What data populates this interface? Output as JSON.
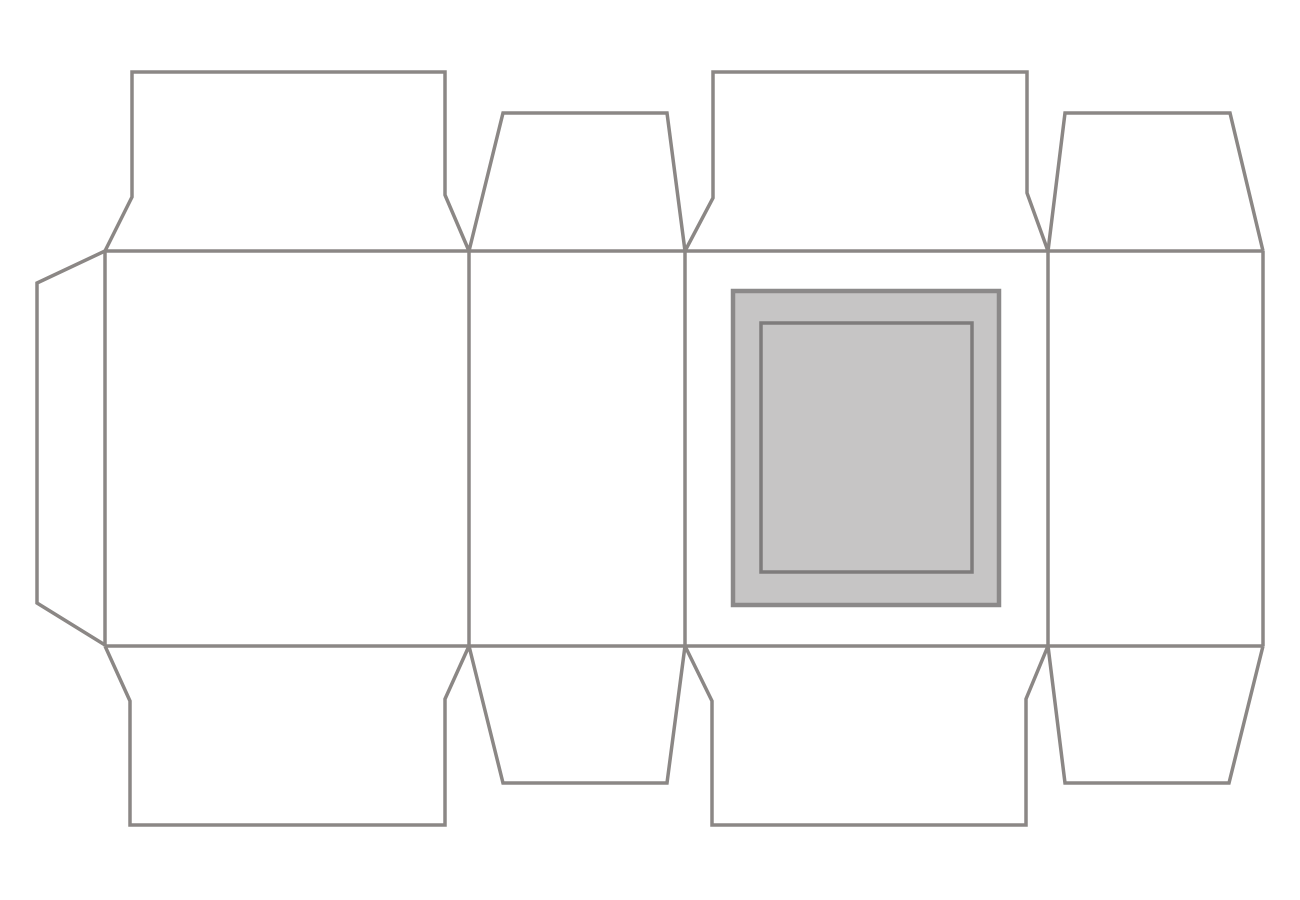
{
  "canvas": {
    "width": 1300,
    "height": 900,
    "background_color": "#ffffff"
  },
  "diagram": {
    "kind": "packaging-dieline",
    "line_color": "#8b8785",
    "line_width": 3.5,
    "window_fill_color": "#c6c5c5",
    "shapes": [
      {
        "name": "glue-tab-outline",
        "kind": "polyline",
        "points": [
          [
            105,
            251
          ],
          [
            37,
            283
          ],
          [
            37,
            603
          ],
          [
            105,
            645
          ]
        ]
      },
      {
        "name": "top-flap-1-outline",
        "kind": "polyline",
        "points": [
          [
            105,
            251
          ],
          [
            132,
            197
          ],
          [
            132,
            72
          ],
          [
            445,
            72
          ],
          [
            445,
            195
          ],
          [
            469,
            251
          ]
        ]
      },
      {
        "name": "top-flap-2-outline",
        "kind": "polyline",
        "points": [
          [
            469,
            251
          ],
          [
            503,
            113
          ],
          [
            667,
            113
          ],
          [
            685,
            251
          ]
        ]
      },
      {
        "name": "top-flap-3-outline",
        "kind": "polyline",
        "points": [
          [
            685,
            251
          ],
          [
            713,
            198
          ],
          [
            713,
            72
          ],
          [
            1027,
            72
          ],
          [
            1027,
            193
          ],
          [
            1048,
            251
          ]
        ]
      },
      {
        "name": "top-flap-4-outline",
        "kind": "polyline",
        "points": [
          [
            1048,
            251
          ],
          [
            1065,
            113
          ],
          [
            1230,
            113
          ],
          [
            1263,
            251
          ]
        ]
      },
      {
        "name": "bottom-flap-1-outline",
        "kind": "polyline",
        "points": [
          [
            105,
            646
          ],
          [
            130,
            701
          ],
          [
            130,
            825
          ],
          [
            445,
            825
          ],
          [
            445,
            699
          ],
          [
            469,
            646
          ]
        ]
      },
      {
        "name": "bottom-flap-2-outline",
        "kind": "polyline",
        "points": [
          [
            469,
            646
          ],
          [
            503,
            783
          ],
          [
            667,
            783
          ],
          [
            685,
            646
          ]
        ]
      },
      {
        "name": "bottom-flap-3-outline",
        "kind": "polyline",
        "points": [
          [
            685,
            646
          ],
          [
            712,
            701
          ],
          [
            712,
            825
          ],
          [
            1026,
            825
          ],
          [
            1026,
            699
          ],
          [
            1048,
            646
          ]
        ]
      },
      {
        "name": "bottom-flap-4-outline",
        "kind": "polyline",
        "points": [
          [
            1048,
            646
          ],
          [
            1065,
            783
          ],
          [
            1229,
            783
          ],
          [
            1263,
            646
          ]
        ]
      },
      {
        "name": "top-fold-line",
        "kind": "line",
        "points": [
          [
            105,
            251
          ],
          [
            1263,
            251
          ]
        ]
      },
      {
        "name": "bottom-fold-line",
        "kind": "line",
        "points": [
          [
            105,
            646
          ],
          [
            1263,
            646
          ]
        ]
      },
      {
        "name": "panel-1-left-edge",
        "kind": "line",
        "points": [
          [
            105,
            251
          ],
          [
            105,
            646
          ]
        ]
      },
      {
        "name": "panel-1-2-fold-line",
        "kind": "line",
        "points": [
          [
            469,
            251
          ],
          [
            469,
            646
          ]
        ]
      },
      {
        "name": "panel-2-3-fold-line",
        "kind": "line",
        "points": [
          [
            685,
            251
          ],
          [
            685,
            646
          ]
        ]
      },
      {
        "name": "panel-3-4-fold-line",
        "kind": "line",
        "points": [
          [
            1048,
            251
          ],
          [
            1048,
            646
          ]
        ]
      },
      {
        "name": "panel-4-right-edge",
        "kind": "line",
        "points": [
          [
            1263,
            251
          ],
          [
            1263,
            646
          ]
        ]
      },
      {
        "name": "window-outer-rect",
        "kind": "rect",
        "x": 733,
        "y": 291,
        "w": 266,
        "h": 314,
        "fill": "#c6c5c5",
        "stroke": "#8b8989",
        "stroke_width": 4.5
      },
      {
        "name": "window-inner-rect",
        "kind": "rect",
        "x": 761,
        "y": 323,
        "w": 211,
        "h": 249,
        "fill": "none",
        "stroke": "#7e7c7c",
        "stroke_width": 3.5
      }
    ]
  }
}
